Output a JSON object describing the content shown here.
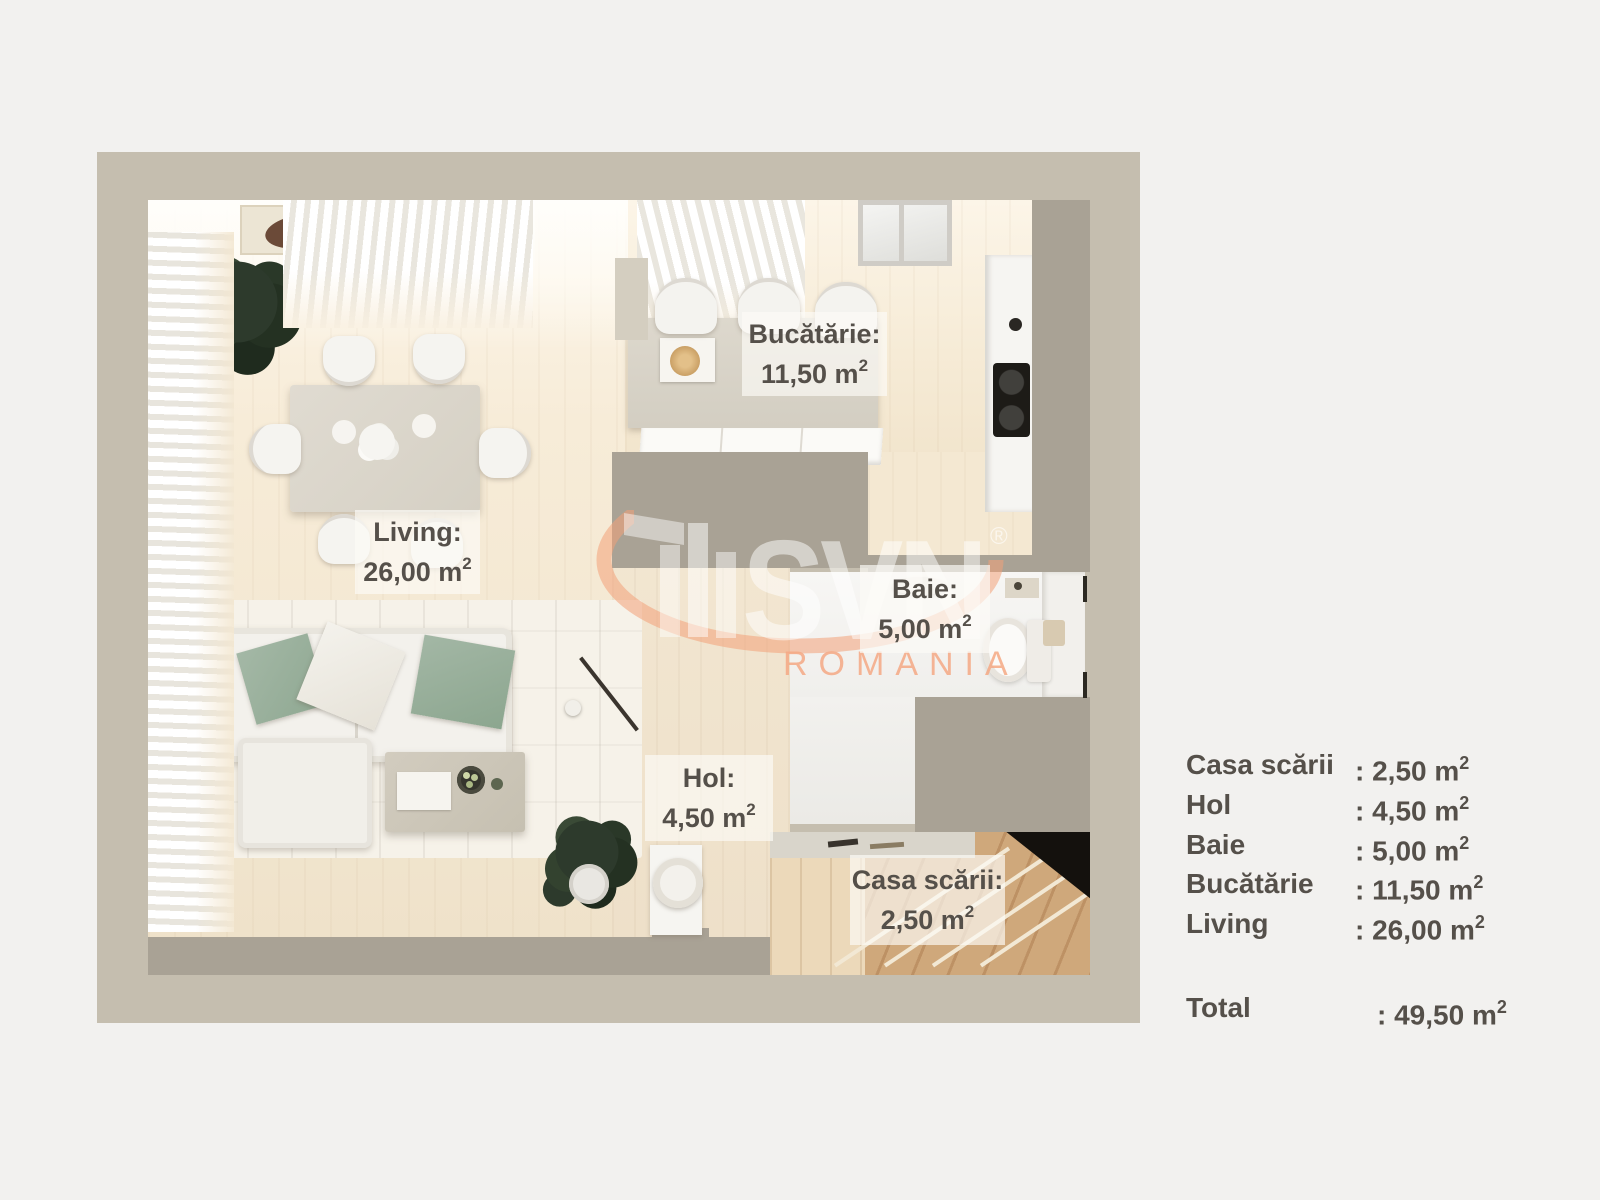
{
  "brand": {
    "name": "SVN",
    "registered": "®",
    "region": "ROMANIA",
    "accent_color": "#f4a884"
  },
  "colors": {
    "page_background": "#f2f1ef",
    "plan_frame": "#c5beaf",
    "interior_wall": "#a9a295",
    "floor_wood": "#f3e7d1",
    "label_text": "#55504a",
    "pillow_green": "#9cb2a0",
    "stair_wood": "#c59e71"
  },
  "room_labels": [
    {
      "title": "Bucătărie:",
      "area": "11,50 m",
      "sup": "2"
    },
    {
      "title": "Living:",
      "area": "26,00 m",
      "sup": "2"
    },
    {
      "title": "Baie:",
      "area": "5,00 m",
      "sup": "2"
    },
    {
      "title": "Hol:",
      "area": "4,50 m",
      "sup": "2"
    },
    {
      "title": "Casa scării:",
      "area": "2,50 m",
      "sup": "2"
    }
  ],
  "legend": {
    "rows": [
      {
        "label": "Casa scării",
        "value": ": 2,50 m",
        "sup": "2"
      },
      {
        "label": "Hol",
        "value": ": 4,50 m",
        "sup": "2"
      },
      {
        "label": "Baie",
        "value": ": 5,00 m",
        "sup": "2"
      },
      {
        "label": "Bucătărie",
        "value": ": 11,50 m",
        "sup": "2"
      },
      {
        "label": "Living",
        "value": ": 26,00 m",
        "sup": "2"
      }
    ],
    "total": {
      "label": "Total",
      "value": ": 49,50 m",
      "sup": "2"
    }
  }
}
